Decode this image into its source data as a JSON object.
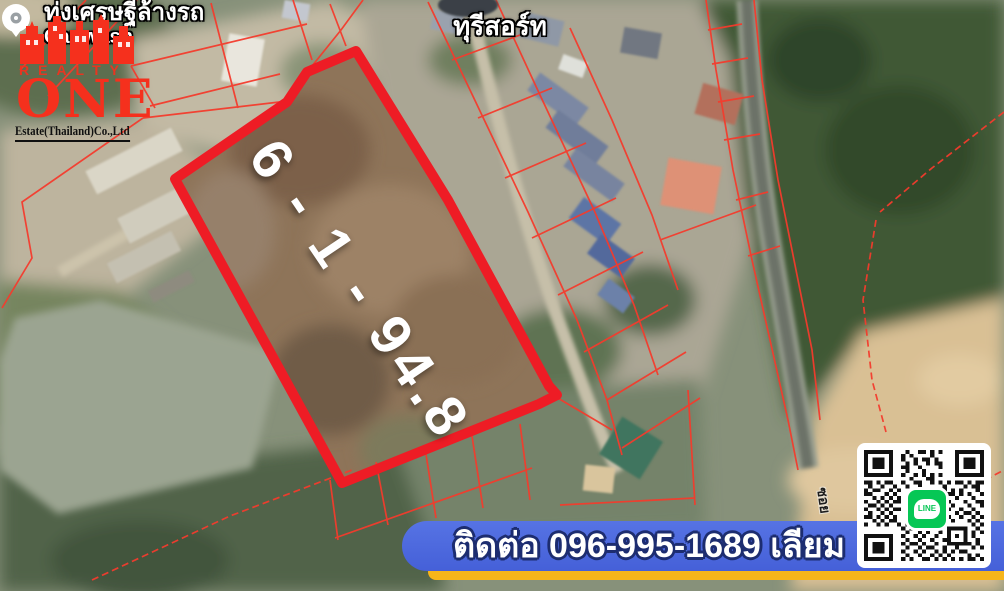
{
  "brand": {
    "realty": "REALTY",
    "one": "ONE",
    "estate": "Estate(Thailand)Co.,Ltd"
  },
  "map_labels": {
    "resort": "ทุรีสอร์ท",
    "carwash_th": "ทุ่งเศรษฐีล้างรถ",
    "carwash_en": "Car wash",
    "road": "ซอย",
    "plot_area": "6 - 1 - 94.8"
  },
  "contact": {
    "banner": "ติดต่อ 096-995-1689 เลียม"
  },
  "qr": {
    "line_label": "LINE"
  },
  "colors": {
    "boundary_red": "#ee1c25",
    "parcel_red": "#f43b2d",
    "banner_blue": "#4b66dd",
    "banner_yellow": "#f6b51a",
    "logo_red": "#f5301d",
    "line_green": "#06c755"
  }
}
